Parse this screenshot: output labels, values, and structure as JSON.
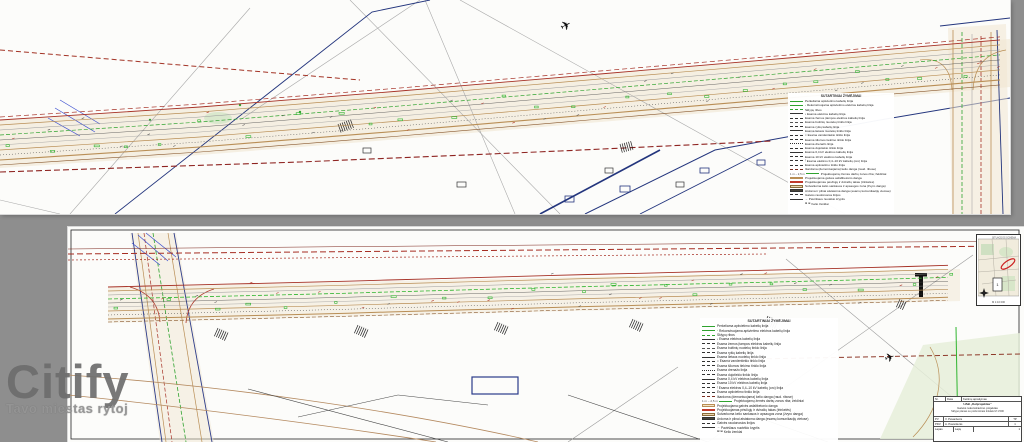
{
  "watermark": {
    "brand": "Citify",
    "tagline": "Tavo miestas rytoj"
  },
  "icons": {
    "plane": "✈",
    "compass": "compass-rose"
  },
  "legend": {
    "title": "SUTARTINIAI ŽYMĖJIMAI",
    "items": [
      {
        "color": "#2fa32f",
        "dash": "solid",
        "w": 1,
        "label": "Perkeliama apšvietimo kabelių linija"
      },
      {
        "color": "#2fa32f",
        "dash": "solid",
        "w": 1,
        "marker": "›",
        "label": "Rekonstruojama apšvietimo elektros kabelių linija"
      },
      {
        "color": "#2fa32f",
        "dash": "dashed",
        "w": 0.8,
        "label": "Sklypų ribos"
      },
      {
        "color": "#333333",
        "dash": "solid",
        "w": 0.8,
        "marker": "•",
        "label": "Esama elektros kabelių linija"
      },
      {
        "color": "#333333",
        "dash": "dashed",
        "w": 0.8,
        "label": "Esama žemos įtampos elektros kabelių linija"
      },
      {
        "color": "#555555",
        "dash": "dashed",
        "w": 0.8,
        "label": "Esama buitinių nuotekų tinklo linija"
      },
      {
        "color": "#333333",
        "dash": "dashed",
        "w": 0.8,
        "label": "Esama ryšių kabelių linija"
      },
      {
        "color": "#333333",
        "dash": "solid",
        "w": 0.8,
        "label": "Esama lietaus nuotekų tinklo linija"
      },
      {
        "color": "#333333",
        "dash": "dashed",
        "w": 0.8,
        "marker": "×",
        "label": "Esama vandentiekio tinklo linija"
      },
      {
        "color": "#333333",
        "dash": "dashed",
        "w": 0.8,
        "label": "Esama šilumos tiekimo tinklo linija"
      },
      {
        "color": "#333333",
        "dash": "dotted",
        "w": 0.8,
        "label": "Esama drenažo linija"
      },
      {
        "color": "#333333",
        "dash": "dashed",
        "w": 0.8,
        "label": "Esama dujotiekio tinklo linija"
      },
      {
        "color": "#333333",
        "dash": "solid",
        "w": 0.8,
        "label": "Esama 0,4 kV elektros kabelių linija"
      },
      {
        "color": "#333333",
        "dash": "dashed",
        "w": 0.8,
        "label": "Esama 10 kV elektros kabelių linija"
      },
      {
        "color": "#333333",
        "dash": "dashed",
        "w": 0.8,
        "marker": "|",
        "label": "Esama elektros 0,4–10 kV kabelių (oro) linija"
      },
      {
        "color": "#333333",
        "dash": "dashed",
        "w": 0.8,
        "label": "Esama apšvietimo tinklo linija"
      },
      {
        "color": "#7a2c20",
        "dash": "dashed",
        "w": 1,
        "label": "Išardoma (demontuojama) kelio danga (raud. ribose)"
      },
      {
        "color": "#2fa32f",
        "dash": "solid",
        "w": 1,
        "prefix": "1 m – 2,5 m",
        "label": "Projektuojamų žemės darbų zonos riba; želdiniai"
      },
      {
        "fill": "#f2e4c8",
        "border": "#b98e55",
        "label": "Projektuojama gatvės asfaltbetonio danga"
      },
      {
        "fill": "#f6d9cf",
        "border": "#c0392b",
        "label": "Projektuojamas pėsčiųjų ir dviračių takas (trinkelės)"
      },
      {
        "fill": "#e8d3ae",
        "border": "#8a6b3a",
        "label": "Sutvarkoma kelio sankasos ir apsaugos zona (žvyro danga)"
      },
      {
        "fill": "#4a463c",
        "border": "#333333",
        "label": "Ardoma ir pilnai atstatoma danga (esamų komunikacijų vietose)"
      },
      {
        "color": "#333333",
        "dash": "dashed",
        "w": 0.8,
        "label": "Gatvės raudonosios linijos"
      },
      {
        "color": "#333333",
        "dash": "solid",
        "w": 0.8,
        "marker": "→",
        "label": "Paviršiaus nuotėkio kryptis"
      },
      {
        "color": "#333333",
        "dash": "none",
        "w": 0,
        "marker": "⊠ ⊞",
        "label": "Kelio ženklai"
      }
    ]
  },
  "title_block": {
    "h1": "Nr.",
    "h2": "Data",
    "h3": "Keitimų aprašymas",
    "org": "UAB „Kelprojektas”",
    "title1": "Gatvės rekonstravimo projektas",
    "title2": "Sklypo planas su požeminiais tinklais M 1:500",
    "r1l": "PV",
    "r1n": "V. Pavardenis",
    "r2l": "PDV",
    "r2n": "A. Pavardenis",
    "stage": "TP",
    "sheet_label": "Lapas",
    "sheet": "1",
    "sheets_label": "Lapų",
    "sheets": "1"
  },
  "inset_map": {
    "title": "SITUACIJOS SCHEMA",
    "frame_label": "1",
    "caption": "M 1:10 000"
  }
}
